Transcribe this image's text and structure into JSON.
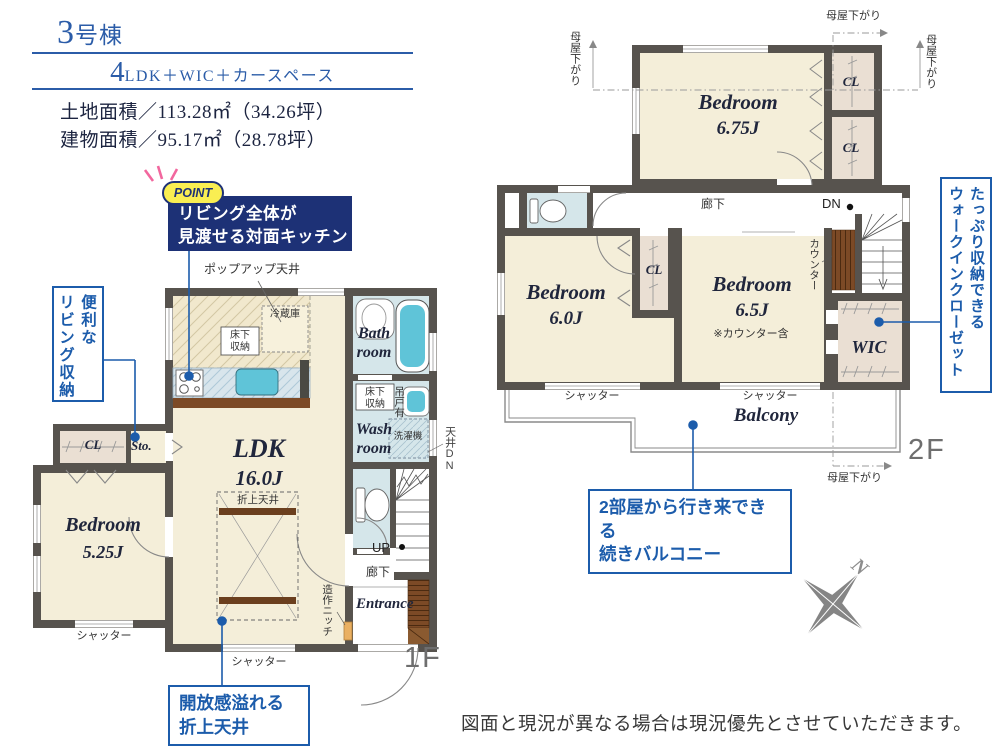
{
  "header": {
    "building_no": "3号棟",
    "plan_digit": "4",
    "plan_suffix": "LDK＋WIC＋カースペース",
    "land_area": "土地面積／113.28㎡（34.26坪）",
    "building_area": "建物面積／95.17㎡（28.78坪）"
  },
  "point": {
    "badge": "POINT",
    "line1": "リビング全体が",
    "line2": "見渡せる対面キッチン"
  },
  "callouts": {
    "living_storage": {
      "col_right": "便利な",
      "col_left": "リビング収納"
    },
    "ceiling": {
      "line1": "開放感溢れる",
      "line2": "折上天井"
    },
    "balcony": {
      "line1": "2部屋から行き来できる",
      "line2": "続きバルコニー"
    },
    "wic": {
      "col_right": "たっぷり収納できる",
      "col_left": "ウォークインクローゼット"
    }
  },
  "floor1": {
    "floor_label": "1F",
    "ldk": "LDK",
    "ldk_size": "16.0J",
    "bedroom": "Bedroom",
    "bedroom_size": "5.25J",
    "bath_l1": "Bath",
    "bath_l2": "room",
    "wash_l1": "Wash",
    "wash_l2": "room",
    "entrance": "Entrance",
    "cl": "CL",
    "sto": "Sto.",
    "popup_ceiling": "ポップアップ天井",
    "refrigerator": "冷蔵庫",
    "underfloor": "床下収納",
    "hanging": "吊戸有",
    "washer": "洗濯機",
    "ceiling_dn": "天井DN",
    "coffered": "折上天井",
    "up": "UP",
    "corridor": "廊下",
    "niche": "造作ニッチ",
    "shutter": "シャッター"
  },
  "floor2": {
    "floor_label": "2F",
    "bedroom1": "Bedroom",
    "bedroom1_size": "6.75J",
    "bedroom2": "Bedroom",
    "bedroom2_size": "6.0J",
    "bedroom3": "Bedroom",
    "bedroom3_size": "6.5J",
    "counter_note": "※カウンター含",
    "wic": "WIC",
    "cl": "CL",
    "balcony": "Balcony",
    "corridor": "廊下",
    "dn": "DN",
    "counter": "カウンター",
    "moya": "母屋下がり",
    "shutter": "シャッター"
  },
  "compass": {
    "north": "N"
  },
  "footer": {
    "disclaimer": "図面と現況が異なる場合は現況優先とさせていただきます。"
  },
  "colors": {
    "accent_blue": "#1c5cab",
    "navy": "#1d3176",
    "yellow": "#f9ee52",
    "wall": "#57534e",
    "cream": "#f4eed9",
    "wet_room": "#d5e6ea",
    "fixture_teal": "#5fc4d8",
    "wood": "#7c4a26",
    "ray_pink": "#f2679e"
  }
}
